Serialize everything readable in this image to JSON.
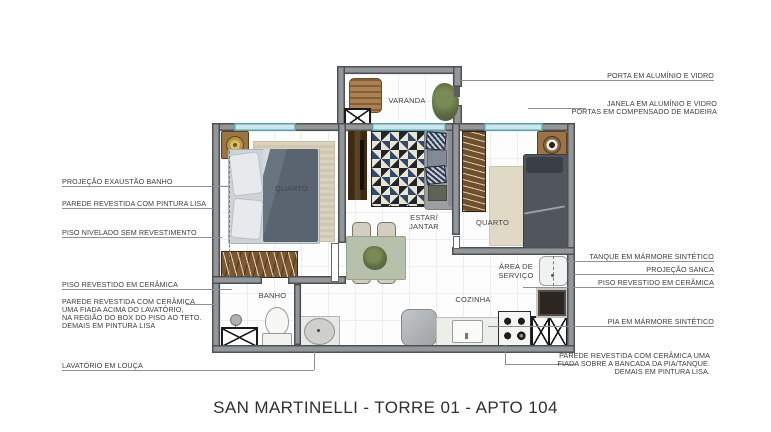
{
  "title": "SAN MARTINELLI - TORRE 01 - APTO 104",
  "rooms": {
    "varanda": "VARANDA",
    "quarto_left": "QUARTO",
    "quarto_right": "QUARTO",
    "estar_line1": "ESTAR/",
    "estar_line2": "JANTAR",
    "banho": "BANHO",
    "cozinha": "COZINHA",
    "area_servico_line1": "ÁREA DE",
    "area_servico_line2": "SERVIÇO"
  },
  "left_labels": {
    "l1": "PROJEÇÃO EXAUSTÃO BANHO",
    "l2": "PAREDE REVESTIDA COM PINTURA LISA",
    "l3": "PISO NIVELADO SEM REVESTIMENTO",
    "l4": "PISO REVESTIDO EM CERÂMICA",
    "l5a": "PAREDE REVESTIDA COM CERÂMICA",
    "l5b": "UMA FIADA ACIMA DO LAVATÓRIO,",
    "l5c": "NA REGIÃO DO BOX DO PISO AO TETO.",
    "l5d": "DEMAIS EM PINTURA LISA",
    "l6": "LAVATÓRIO EM LOUÇA"
  },
  "right_labels": {
    "r1": "PORTA EM ALUMÍNIO E VIDRO",
    "r2a": "JANELA EM ALUMÍNIO E VIDRO",
    "r2b": "PORTAS EM COMPENSADO DE MADEIRA",
    "r3": "TANQUE EM MÁRMORE SINTÉTICO",
    "r4": "PROJEÇÃO SANCA",
    "r5": "PISO REVESTIDO EM CERÂMICA",
    "r6": "PIA EM MÁRMORE SINTÉTICO",
    "r7a": "PAREDE REVESTIDA COM CERÂMICA UMA",
    "r7b": "FIADA SOBRE A BANCADA DA PIA/TANQUE.",
    "r7c": "DEMAIS EM PINTURA LISA."
  },
  "colors": {
    "wall_fill": "#93979a",
    "wall_edge": "#4d5154",
    "window_glass": "#cfe6e8",
    "window_frame": "#57a3ab",
    "wood_brown": "#7c5832",
    "rug_navy": "#31496b",
    "rug_cream": "#eae4d3",
    "leader_line": "#8f8f8f",
    "label_text": "#3e3e3e",
    "title_text": "#303030"
  }
}
